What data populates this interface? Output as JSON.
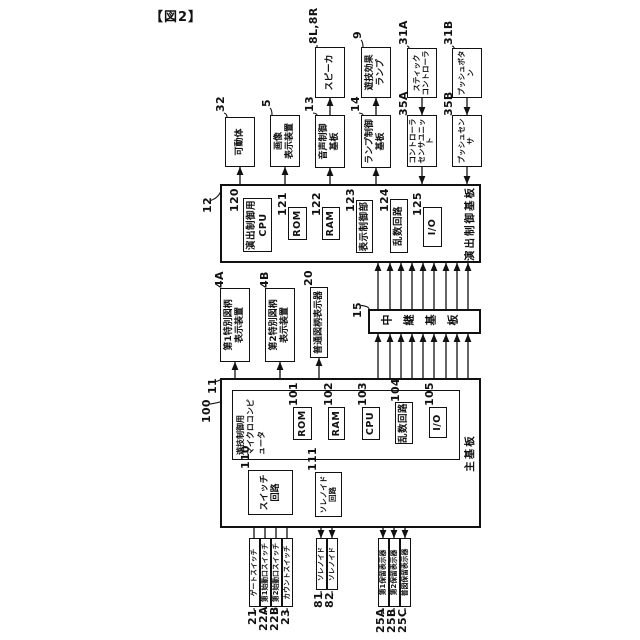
{
  "figure_label": "【図2】",
  "colors": {
    "line": "#111111",
    "background": "#ffffff"
  },
  "diagram": {
    "nodes": [
      {
        "id": "main-board",
        "ref": "11",
        "lines": [
          "主基板"
        ]
      },
      {
        "id": "effect-control-board",
        "ref": "12",
        "lines": [
          "演出制御基板"
        ]
      },
      {
        "id": "relay-board",
        "ref": "15",
        "lines": [
          "中継基板"
        ]
      },
      {
        "id": "game-control-micro",
        "ref": "100",
        "lines": [
          "遊技制御用",
          "マイクロコンピュータ"
        ]
      },
      {
        "id": "rom-101",
        "ref": "101",
        "lines": [
          "ROM"
        ]
      },
      {
        "id": "ram-102",
        "ref": "102",
        "lines": [
          "RAM"
        ]
      },
      {
        "id": "cpu-103",
        "ref": "103",
        "lines": [
          "CPU"
        ]
      },
      {
        "id": "random-circuit-104",
        "ref": "104",
        "lines": [
          "乱数回路"
        ]
      },
      {
        "id": "io-105",
        "ref": "105",
        "lines": [
          "I/O"
        ]
      },
      {
        "id": "switch-circuit-110",
        "ref": "110",
        "lines": [
          "スイッチ",
          "回路"
        ]
      },
      {
        "id": "solenoid-circuit-111",
        "ref": "111",
        "lines": [
          "ソレノイド",
          "回路"
        ]
      },
      {
        "id": "special-display-1",
        "ref": "4A",
        "lines": [
          "第1特別図柄",
          "表示装置"
        ]
      },
      {
        "id": "special-display-2",
        "ref": "4B",
        "lines": [
          "第2特別図柄",
          "表示装置"
        ]
      },
      {
        "id": "normal-display",
        "ref": "20",
        "lines": [
          "普通図柄表示器"
        ]
      },
      {
        "id": "effect-cpu-120",
        "ref": "120",
        "lines": [
          "演出制御用",
          "CPU"
        ]
      },
      {
        "id": "rom-121",
        "ref": "121",
        "lines": [
          "ROM"
        ]
      },
      {
        "id": "ram-122",
        "ref": "122",
        "lines": [
          "RAM"
        ]
      },
      {
        "id": "display-control-123",
        "ref": "123",
        "lines": [
          "表示制御部"
        ]
      },
      {
        "id": "random-circuit-124",
        "ref": "124",
        "lines": [
          "乱数回路"
        ]
      },
      {
        "id": "io-125",
        "ref": "125",
        "lines": [
          "I/O"
        ]
      },
      {
        "id": "movable-body",
        "ref": "32",
        "lines": [
          "可動体"
        ]
      },
      {
        "id": "image-display-device",
        "ref": "5",
        "lines": [
          "画像",
          "表示装置"
        ]
      },
      {
        "id": "sound-control-board",
        "ref": "13",
        "lines": [
          "音声制御",
          "基板"
        ]
      },
      {
        "id": "lamp-control-board",
        "ref": "14",
        "lines": [
          "ランプ制御",
          "基板"
        ]
      },
      {
        "id": "controller-sensor-unit",
        "ref": "35A",
        "lines": [
          "コントローラ",
          "センサユニット"
        ]
      },
      {
        "id": "push-sensor",
        "ref": "35B",
        "lines": [
          "プッシュセンサ"
        ]
      },
      {
        "id": "speaker",
        "ref": "8L,8R",
        "lines": [
          "スピーカ"
        ]
      },
      {
        "id": "game-effect-lamp",
        "ref": "9",
        "lines": [
          "遊技効果",
          "ランプ"
        ]
      },
      {
        "id": "stick-controller",
        "ref": "31A",
        "lines": [
          "スティック",
          "コントローラ"
        ]
      },
      {
        "id": "push-button",
        "ref": "31B",
        "lines": [
          "プッシュボタン"
        ]
      },
      {
        "id": "gate-switch",
        "ref": "21",
        "lines": [
          "ゲートスイッチ"
        ]
      },
      {
        "id": "start-switch-1",
        "ref": "22A",
        "lines": [
          "第1始動口スイッチ"
        ]
      },
      {
        "id": "start-switch-2",
        "ref": "22B",
        "lines": [
          "第2始動口スイッチ"
        ]
      },
      {
        "id": "count-switch",
        "ref": "23",
        "lines": [
          "カウントスイッチ"
        ]
      },
      {
        "id": "solenoid-81",
        "ref": "81",
        "lines": [
          "ソレノイド"
        ]
      },
      {
        "id": "solenoid-82",
        "ref": "82",
        "lines": [
          "ソレノイド"
        ]
      },
      {
        "id": "hold-display-1",
        "ref": "25A",
        "lines": [
          "第1保留表示器"
        ]
      },
      {
        "id": "hold-display-2",
        "ref": "25B",
        "lines": [
          "第2保留表示器"
        ]
      },
      {
        "id": "normal-hold-display",
        "ref": "25C",
        "lines": [
          "普図保留表示器"
        ]
      }
    ]
  }
}
